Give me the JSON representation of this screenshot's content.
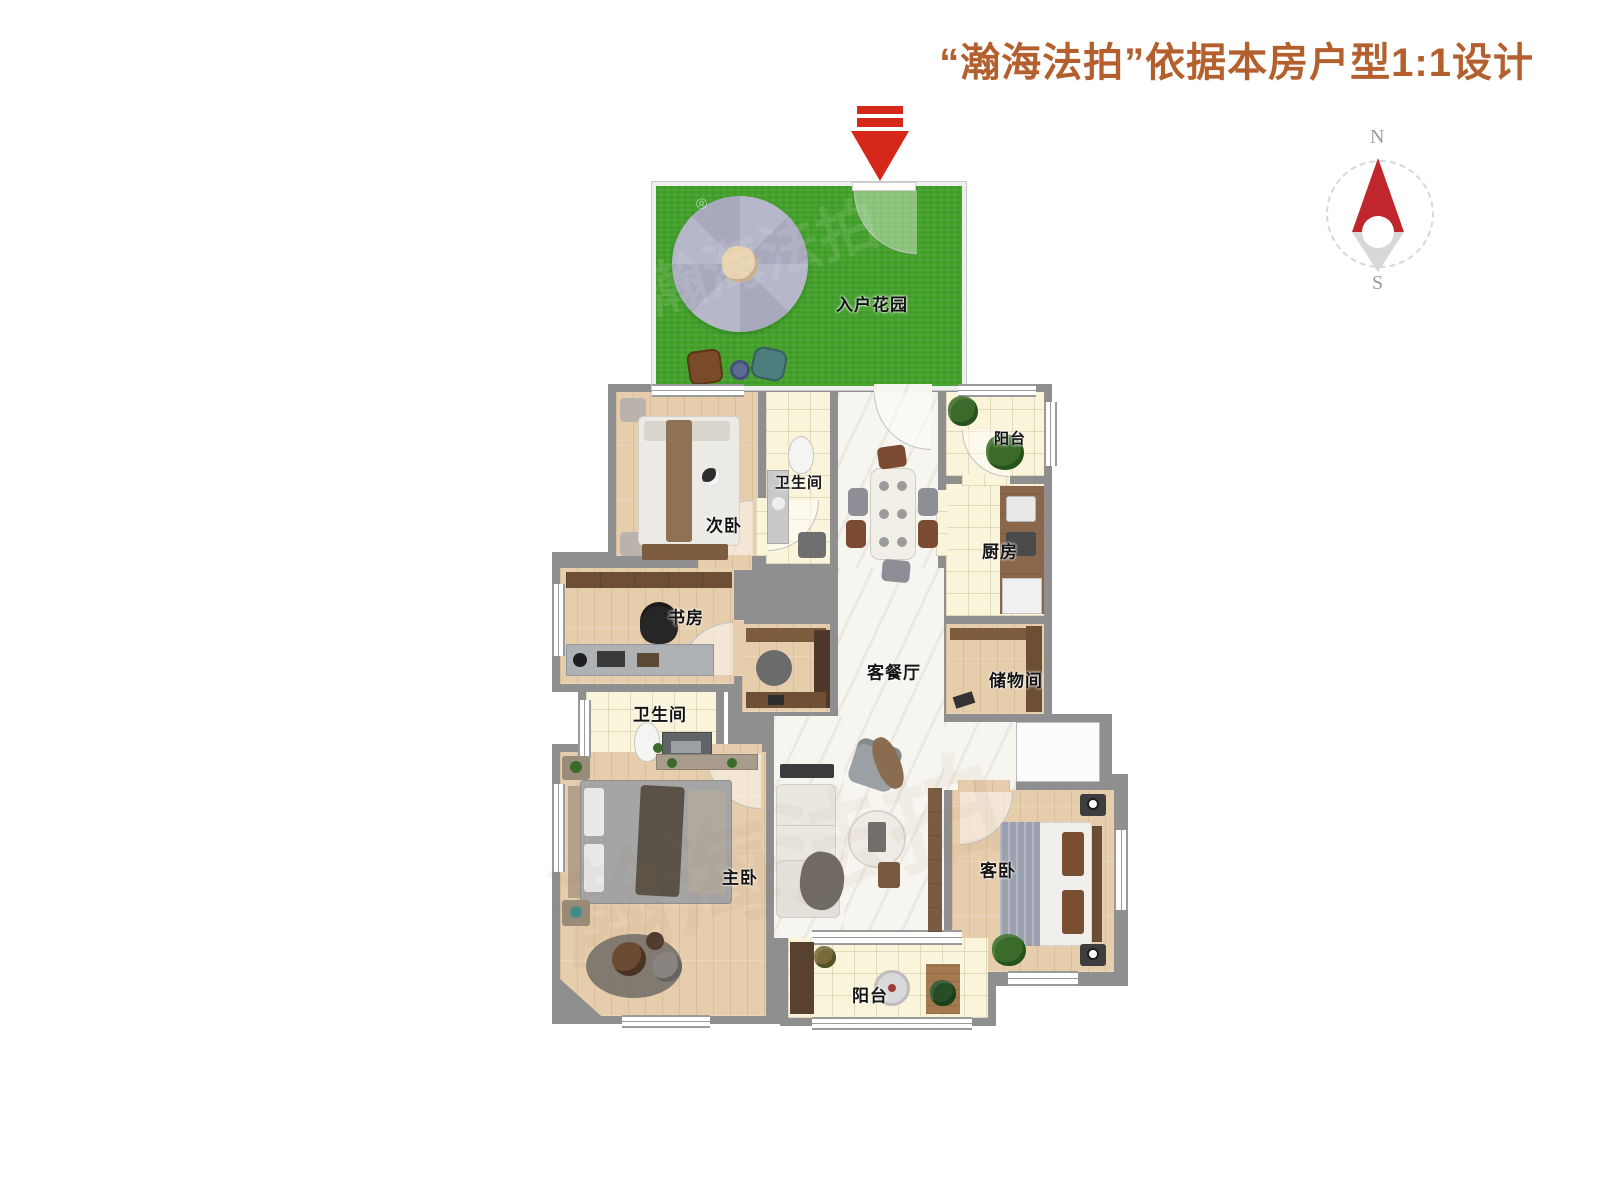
{
  "title": {
    "text": "“瀚海法拍”依据本房户型1:1设计",
    "color": "#b4602e"
  },
  "compass": {
    "north_label": "N",
    "south_label": "S"
  },
  "icons": {
    "entry_arrow": "red-arrow-down",
    "compass_needle": "compass-needle",
    "umbrella": "patio-umbrella"
  },
  "rooms": [
    {
      "id": "entry-garden",
      "label": "入户花园"
    },
    {
      "id": "bedroom-2",
      "label": "次卧"
    },
    {
      "id": "bathroom-1",
      "label": "卫生间"
    },
    {
      "id": "balcony-top",
      "label": "阳台"
    },
    {
      "id": "kitchen",
      "label": "厨房"
    },
    {
      "id": "study",
      "label": "书房"
    },
    {
      "id": "living-dining",
      "label": "客餐厅"
    },
    {
      "id": "storage",
      "label": "储物间"
    },
    {
      "id": "bathroom-2",
      "label": "卫生间"
    },
    {
      "id": "master-bedroom",
      "label": "主卧"
    },
    {
      "id": "guest-bedroom",
      "label": "客卧"
    },
    {
      "id": "balcony-bottom",
      "label": "阳台"
    }
  ],
  "watermark": {
    "brand_text": "瀚海法拍",
    "registered_mark": "®"
  },
  "colors": {
    "title": "#b4602e",
    "arrow_red": "#d5281b",
    "compass_red": "#c0272d",
    "grass_green": "#44a12b",
    "wood_floor": "#e6cdab",
    "tile_cream": "#faf4da",
    "marble_white": "#f7f5ef",
    "wall_gray": "#8f8f8f"
  }
}
